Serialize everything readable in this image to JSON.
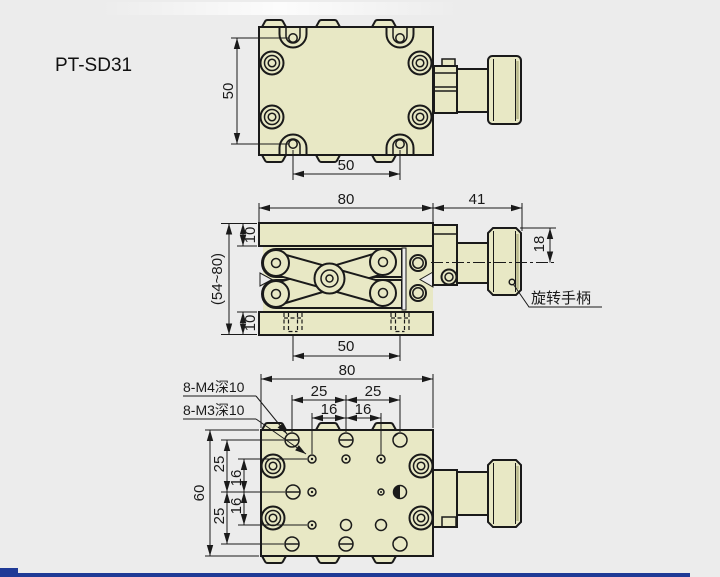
{
  "product": {
    "model": "PT-SD31"
  },
  "colors": {
    "background": "#ececec",
    "part_fill": "#e8e8c5",
    "line": "#1a1a1a",
    "shade": "#b9b98c",
    "footer_bar": "#1f3a96"
  },
  "top_view": {
    "dim_height": "50",
    "dim_hole_spacing": "50"
  },
  "front_view": {
    "dim_width": "80",
    "dim_handle_length": "41",
    "dim_top_plate": "10",
    "dim_height_range": "(54~80)",
    "dim_bottom_plate": "10",
    "dim_handle_offset": "18",
    "dim_bolt_spacing": "50",
    "handle_label": "旋转手柄"
  },
  "bottom_view": {
    "callout_m4": "8-M4深10",
    "callout_m3": "8-M3深10",
    "dim_width": "80",
    "dim_col_25_left": "25",
    "dim_col_25_right": "25",
    "dim_col_16_left": "16",
    "dim_col_16_right": "16",
    "dim_height": "60",
    "dim_row_25_top": "25",
    "dim_row_16_top": "16",
    "dim_row_16_bottom": "16",
    "dim_row_25_bottom": "25"
  }
}
